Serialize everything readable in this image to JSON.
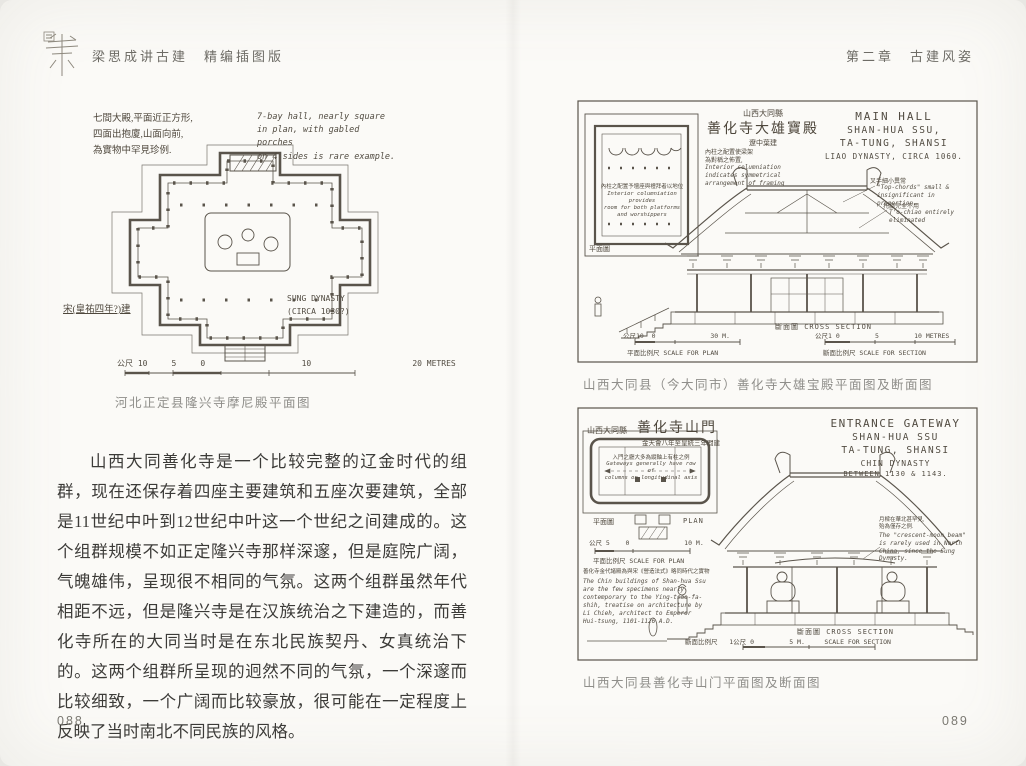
{
  "colors": {
    "page": "#fbfaf7",
    "ink": "#5a544b",
    "body_text": "#3c3b38",
    "caption": "#8f8e8a"
  },
  "header": {
    "left_title": "梁思成讲古建　精编插图版",
    "right_title": "第二章　古建风姿"
  },
  "left_page": {
    "page_number": "088",
    "figure": {
      "note_cn": "七間大殿,平面近正方形,\n四面出抱廈,山面向前,\n為實物中罕見珍例.",
      "note_en": "7-bay hall, nearly square\nin plan, with gabled porches\non 4 sides is rare example.",
      "date_cn": "宋(皇祐四年?)建",
      "date_en": "SUNG DYNASTY\n(CIRCA 1030?)",
      "scale_label": "公尺 10     5     0                    10                     20 METRES",
      "caption": "河北正定县隆兴寺摩尼殿平面图"
    },
    "paragraph": "山西大同善化寺是一个比较完整的辽金时代的组群，现在还保存着四座主要建筑和五座次要建筑，全部是11世纪中叶到12世纪中叶这一个世纪之间建成的。这个组群规模不如正定隆兴寺那样深邃，但是庭院广阔，气魄雄伟，呈现很不相同的气氛。这两个组群虽然年代相距不远，但是隆兴寺是在汉族统治之下建造的，而善化寺所在的大同当时是在东北民族契丹、女真统治下的。这两个组群所呈现的迥然不同的气氛，一个深邃而比较细致，一个广阔而比较豪放，很可能在一定程度上反映了当时南北不同民族的风格。"
  },
  "right_page": {
    "page_number": "089",
    "figure_top": {
      "loc_cn": "山西大同縣",
      "title_cn": "善化寺大雄寶殿",
      "date_cn": "遼中葉建",
      "note_cn": "內柱之配置使梁架\n為對稱之佈置,",
      "note_en": "Interior columniation\nindicates symmetrical\narrangement of framing",
      "title_en_1": "MAIN HALL",
      "title_en_2": "SHAN-HUA SSU,",
      "title_en_3": "TA-TUNG, SHANSI",
      "title_en_4": "LIAO DYNASTY, CIRCA 1060.",
      "plan_note_cn": "內柱之配置予壇座與禮拜者以地位",
      "plan_note_en": "Interior columniation provides\nroom for both platforms\nand worshippers",
      "plan_label": "平面圖",
      "note_r1_cn": "叉手細小異常",
      "note_r1_en": "\"Top-chords\" small &\ninsignificant in proportion.",
      "note_r2_cn": "托腳完全不用",
      "note_r2_en": "T'o-chiao entirely\neliminated",
      "section_label": "斷面圖    CROSS SECTION",
      "scale_plan": "公尺10  0              30 M.",
      "scale_plan_name": "平面比例尺   SCALE FOR PLAN",
      "scale_section": "公尺1 0         5         10 METRES",
      "scale_section_name": "斷面比例尺   SCALE FOR SECTION",
      "caption": "山西大同县（今大同市）善化寺大雄宝殿平面图及断面图"
    },
    "figure_bottom": {
      "loc_cn": "山西大同縣",
      "title_cn": "善化寺山門",
      "date_cn": "金天會八年至皇統三年間建",
      "title_en_1": "ENTRANCE GATEWAY",
      "title_en_2": "SHAN-HUA SSU",
      "title_en_3": "TA-TUNG, SHANSI",
      "title_en_4": "CHIN DYNASTY",
      "title_en_5": "BETWEEN 1130 & 1143.",
      "plan_note_cn": "入門之廳大多為縱軸上有柱之例",
      "plan_note_en": "Gateways generally have row of\ncolumns on longitudinal axis",
      "plan_label_cn": "平面圖",
      "plan_label_en": "PLAN",
      "scale_plan": "公尺 5    0              10 M.",
      "scale_plan_name": "平面比例尺   SCALE FOR PLAN",
      "chin_note_cn": "善化寺金代諸殿為與宋《營造法式》略同時代之實物",
      "chin_note_en": "The Chin buildings of Shan-hua Ssu\nare the few specimens nearly\ncontemporary to the Ying-tsao-fa-\nshih, treatise on architecture by\nLi Chieh, architect to Emperor\nHui-tsung, 1101-1126 A.D.",
      "moon_note_cn": "月樑在華北甚罕見,\n殆為僅存之例.",
      "moon_note_en": "The \"crescent-moon beam\"\nis rarely used in North\nChina, since the Sung\nDynasty.",
      "section_label": "斷面圖    CROSS SECTION",
      "scale_section": "斷面比例尺   1公尺 0         5 M.     SCALE FOR SECTION",
      "caption": "山西大同县善化寺山门平面图及断面图"
    }
  }
}
